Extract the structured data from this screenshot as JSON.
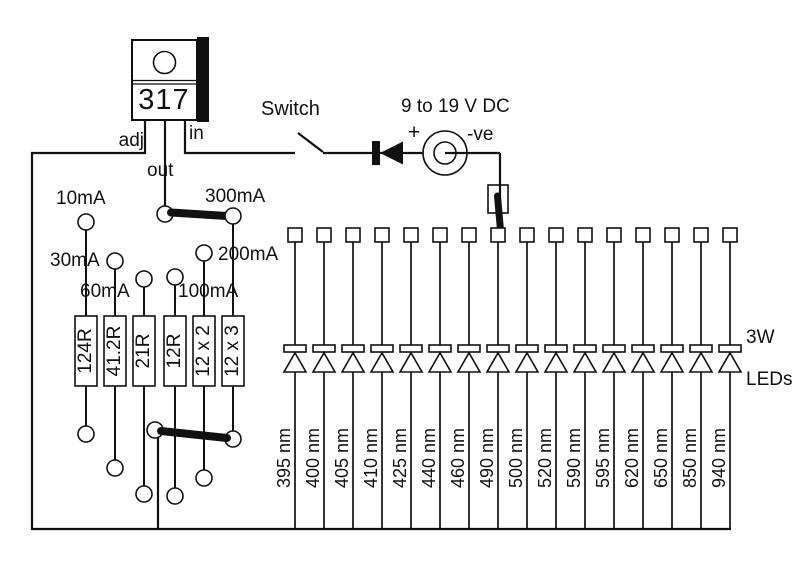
{
  "colors": {
    "ink": "#111111",
    "background": "#ffffff"
  },
  "regulator": {
    "part": "317",
    "pins": {
      "adj": "adj",
      "out": "out",
      "in": "in"
    }
  },
  "power": {
    "switch_label": "Switch",
    "supply_label": "9 to 19 V DC",
    "plus_label": "+",
    "minus_label": "-ve"
  },
  "current_settings": {
    "items": [
      {
        "resistor": "124R",
        "current": "10mA"
      },
      {
        "resistor": "41.2R",
        "current": "30mA"
      },
      {
        "resistor": "21R",
        "current": "60mA"
      },
      {
        "resistor": "12R",
        "current": "100mA"
      },
      {
        "resistor": "12 x 2",
        "current": "200mA"
      },
      {
        "resistor": "12 x 3",
        "current": "300mA"
      }
    ],
    "selected_current": "300mA"
  },
  "led_bank": {
    "power_label": "3W",
    "type_label": "LEDs",
    "wavelengths": [
      "395 nm",
      "400 nm",
      "405 nm",
      "410 nm",
      "425 nm",
      "440 nm",
      "460 nm",
      "490 nm",
      "500 nm",
      "520 nm",
      "590 nm",
      "595 nm",
      "620 nm",
      "650 nm",
      "850 nm",
      "940 nm"
    ],
    "selected_wavelength": "490 nm"
  }
}
